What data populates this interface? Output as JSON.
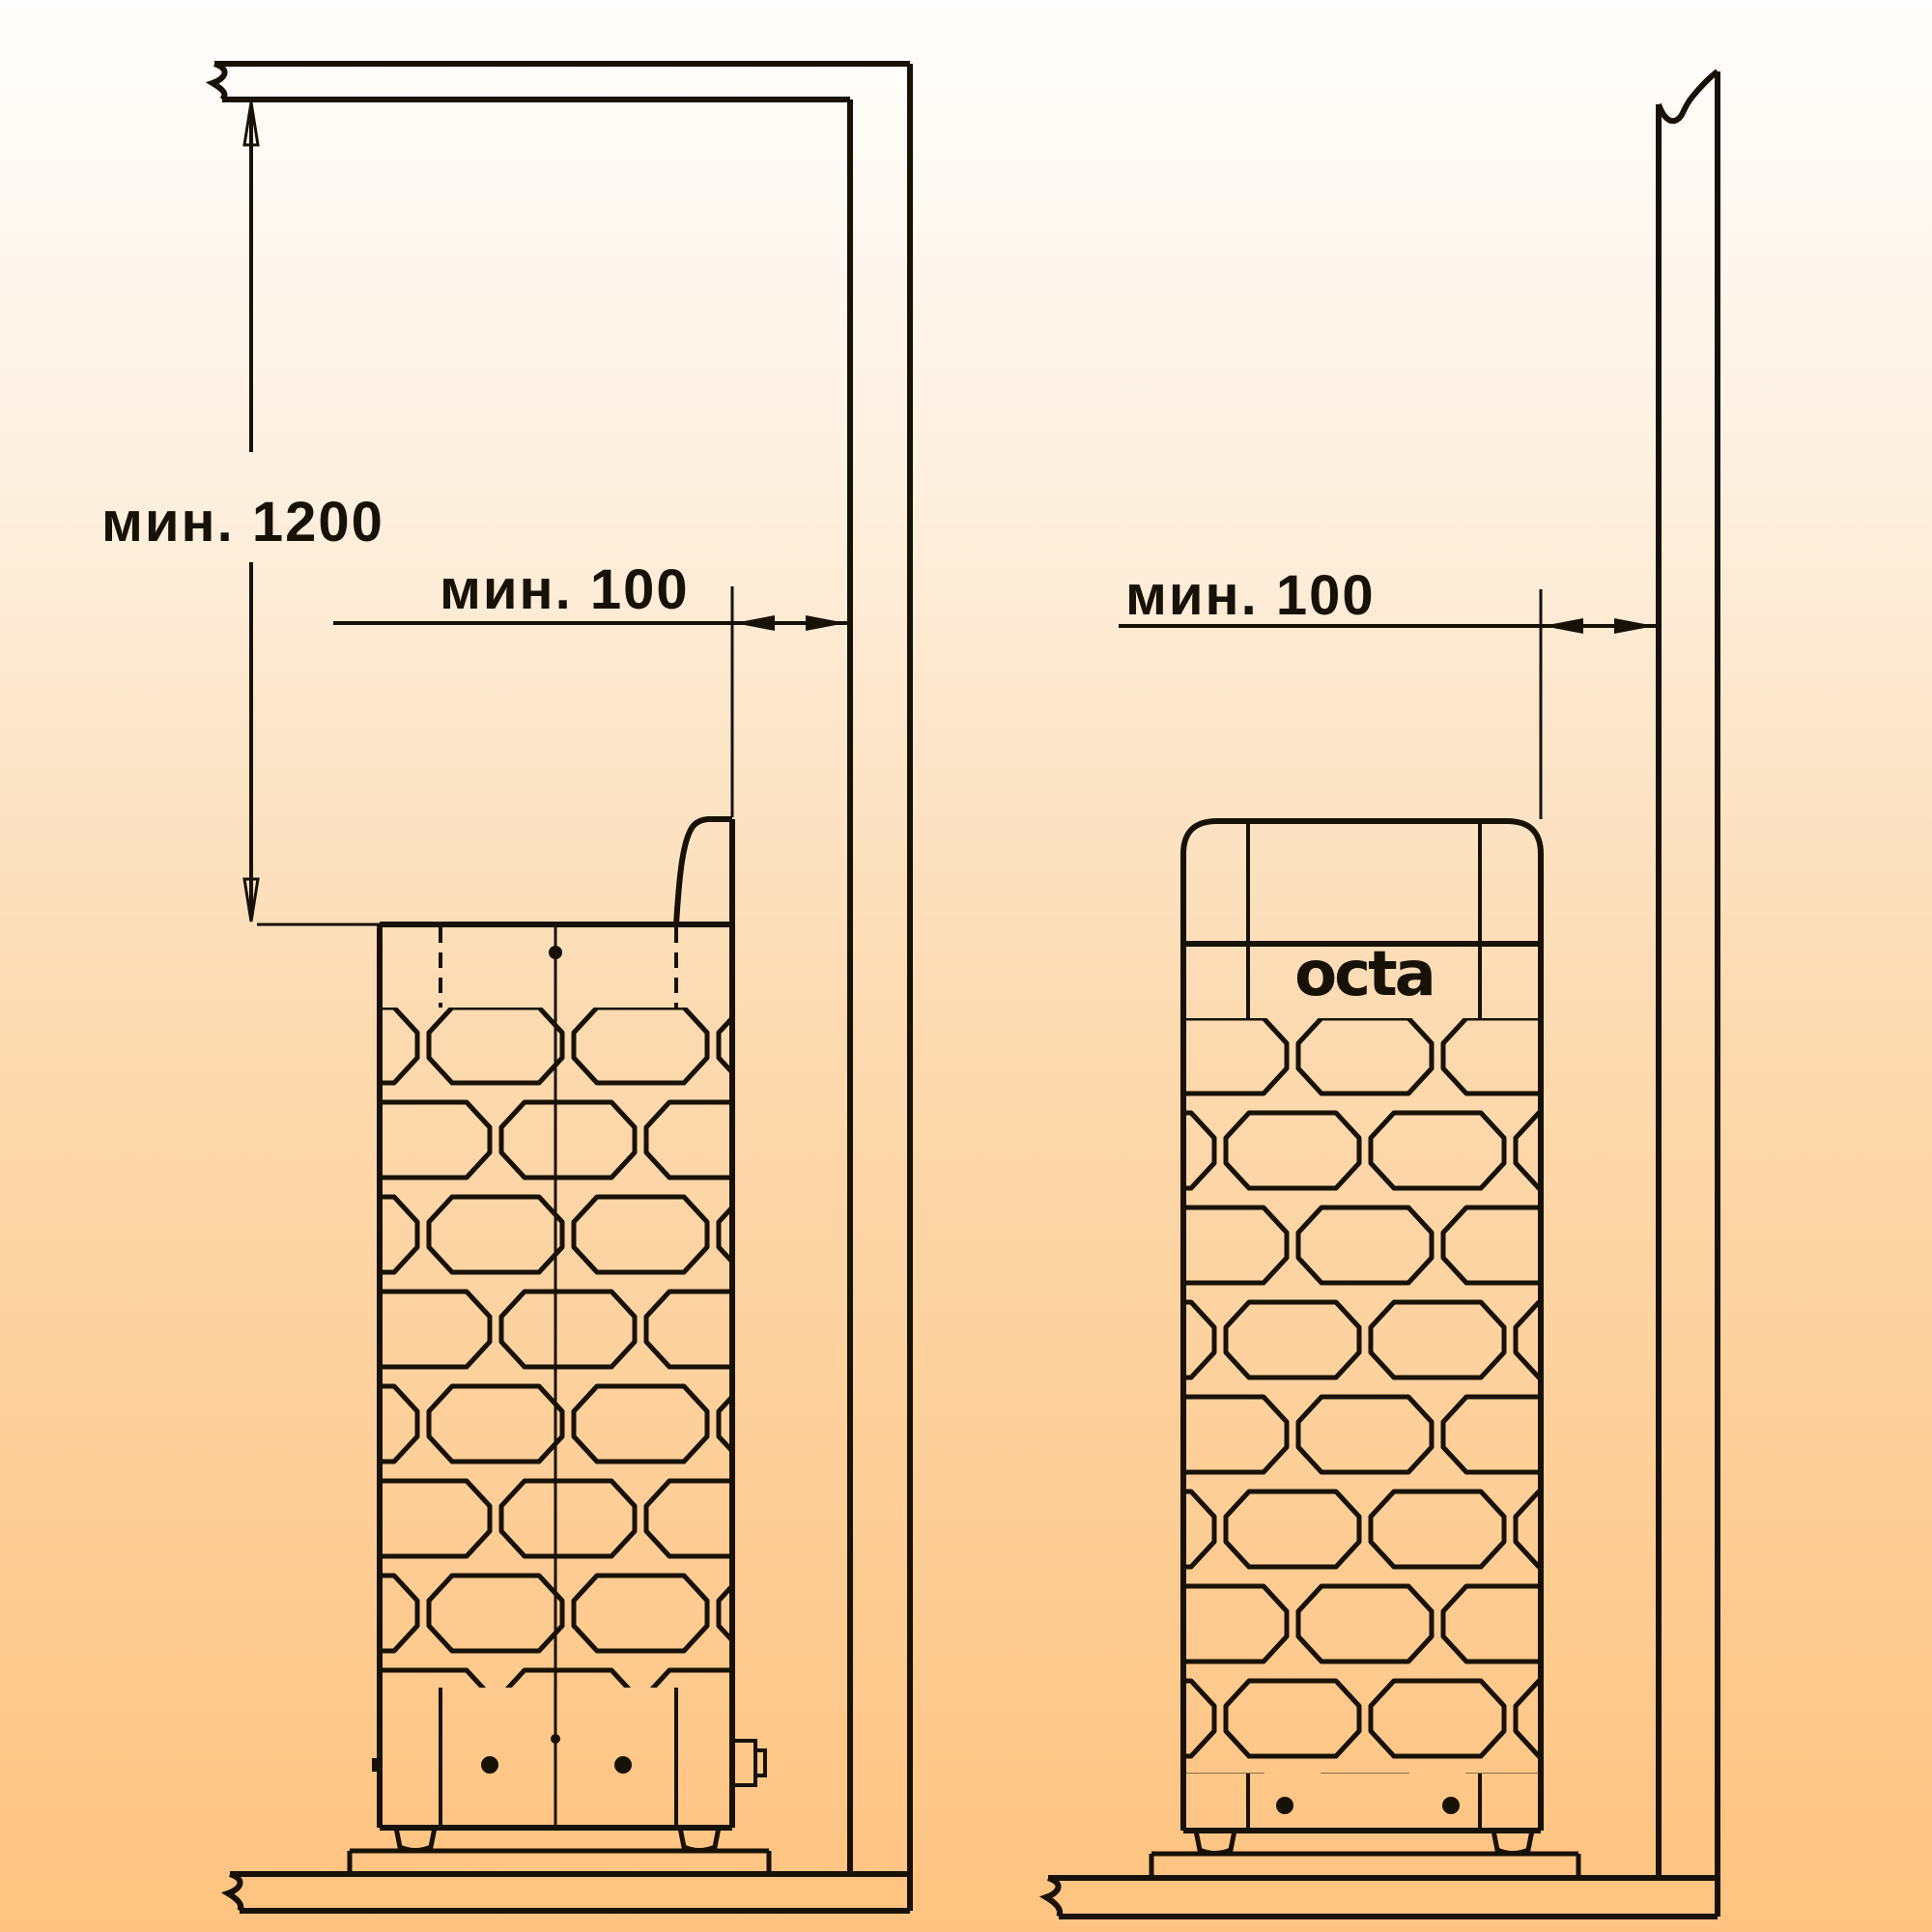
{
  "diagram": {
    "description": "sauna heater installation clearance drawing, two views",
    "colors": {
      "background_top": "#fffefe",
      "background_mid": "#fcd9ae",
      "background_bottom": "#fec380",
      "line": "#181106",
      "text": "#181106"
    },
    "left_view": {
      "dim_vertical": {
        "label": "мин. 1200"
      },
      "dim_horizontal": {
        "label": "мин. 100"
      }
    },
    "right_view": {
      "dim_horizontal": {
        "label": "мин. 100"
      },
      "logo": "octa"
    }
  }
}
